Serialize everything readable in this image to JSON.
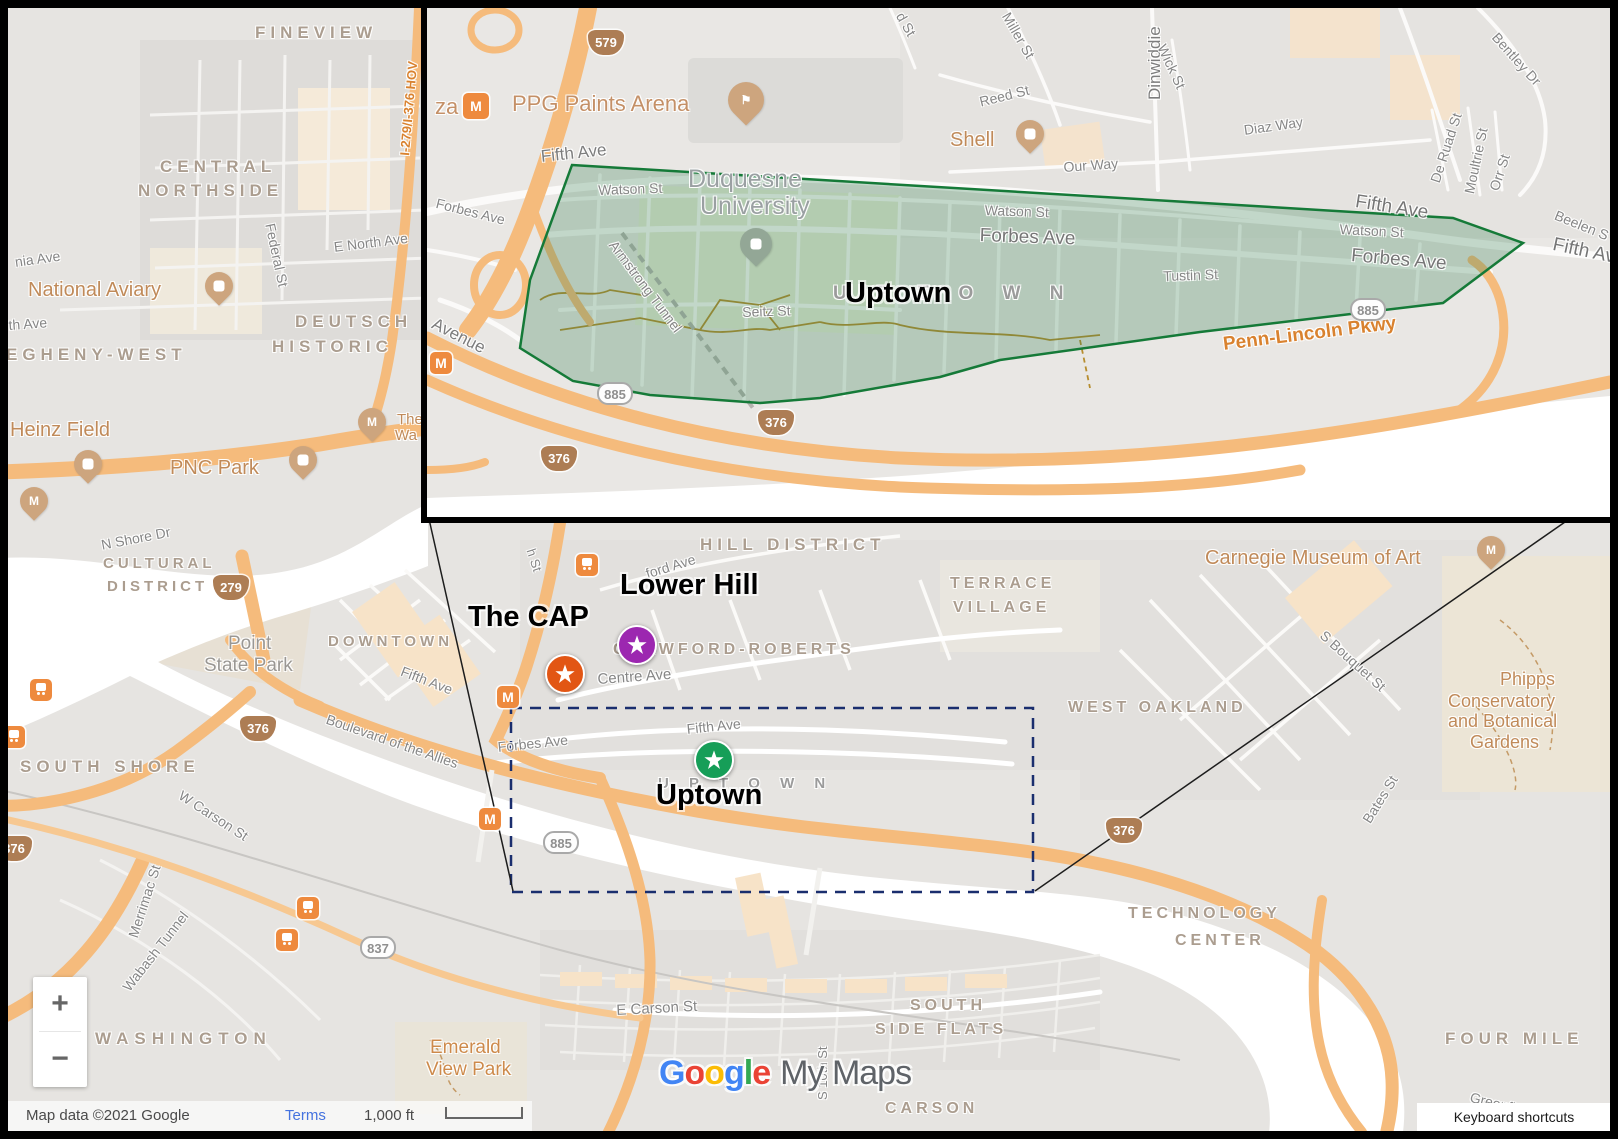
{
  "inset": {
    "labels": {
      "ppg_arena": "PPG Paints Arena",
      "za": "za",
      "m": "M",
      "fifth_ave": "Fifth Ave",
      "forbes_ave": "Forbes Ave",
      "watson_st": "Watson St",
      "duquesne_1": "Duquesne",
      "duquesne_2": "University",
      "uptown_bold": "Uptown",
      "uptown_area": "U P T O W N",
      "seitz_st": "Seitz St",
      "armstrong_tunnel": "Armstrong Tunnel",
      "tustin_st": "Tustin St",
      "penn_lincoln": "Penn-Lincoln Pkwy",
      "our_way": "Our Way",
      "diaz_way": "Diaz Way",
      "reed_st": "Reed St",
      "miller_st": "Miller St",
      "d_st": "d St",
      "dinwiddie": "Dinwiddie",
      "wick_st": "Wick St",
      "shell": "Shell",
      "bentley_dr": "Bentley Dr",
      "de_ruad_st": "De Ruad St",
      "moultrie_st": "Moultrie St",
      "orr_st": "Orr St",
      "beelen": "Beelen S",
      "avenue": "Avenue"
    }
  },
  "main": {
    "labels": {
      "fineview": "FINEVIEW",
      "central": "CENTRAL",
      "northside": "NORTHSIDE",
      "nia_ave": "nia Ave",
      "national_aviary": "National Aviary",
      "th_ave": "th Ave",
      "federal_st": "Federal St",
      "e_north_ave": "E North Ave",
      "deutsch": "DEUTSCH",
      "historic": "HISTORIC",
      "egheny_west": "EGHENY-WEST",
      "heinz_field": "Heinz Field",
      "pnc_park": "PNC Park",
      "the_1": "The",
      "the_2": "Wa",
      "n_shore_dr": "N Shore Dr",
      "cultural": "CULTURAL",
      "district": "DISTRICT",
      "downtown": "DOWNTOWN",
      "point_1": "Point",
      "point_2": "State Park",
      "fifth_ave": "Fifth Ave",
      "blvd_allies": "Boulevard of the Allies",
      "south_shore": "SOUTH SHORE",
      "w_carson_st": "W Carson St",
      "merrimac_st": "Merrimac St",
      "wabash_tunnel": "Wabash Tunnel",
      "washington": "WASHINGTON",
      "emerald_1": "Emerald",
      "emerald_2": "View Park",
      "hill_district": "HILL DISTRICT",
      "bedford_ave": "ford Ave",
      "h_st": "h St",
      "centre_ave": "Centre Ave",
      "forbes_ave": "Forbes Ave",
      "crawford_roberts": "CRAWFORD-ROBERTS",
      "terrace": "TERRACE",
      "village": "VILLAGE",
      "west_oakland": "WEST OAKLAND",
      "carnegie": "Carnegie Museum of Art",
      "s_bouquet_st": "S Bouquet St",
      "phipps_1": "Phipps",
      "phipps_2": "Conservatory",
      "phipps_3": "and Botanical",
      "phipps_4": "Gardens",
      "bates_st": "Bates St",
      "technology": "TECHNOLOGY",
      "center": "CENTER",
      "four_mile": "FOUR MILE",
      "greenfield_ave": "Greenfield Ave",
      "e_carson_st": "E Carson St",
      "south": "SOUTH",
      "side_flats": "SIDE FLATS",
      "carson": "CARSON",
      "s_10th_st": "S 10th St",
      "uptown_area": "U P T O W N",
      "hov": "I-279/I-376 HOV"
    }
  },
  "markers": [
    {
      "label": "The CAP",
      "color": "#E25614"
    },
    {
      "label": "Lower Hill",
      "color": "#9C27B0"
    },
    {
      "label": "Uptown",
      "color": "#169E58"
    }
  ],
  "shields": {
    "i579": "579",
    "i376": "376",
    "i279": "279",
    "r885": "885",
    "r837": "837"
  },
  "ui": {
    "zoom_in": "+",
    "zoom_out": "−",
    "attribution": "Map data ©2021 Google",
    "terms": "Terms",
    "scale_text": "1,000 ft",
    "keyboard_shortcuts": "Keyboard shortcuts"
  },
  "watermark": {
    "letters": [
      {
        "ch": "G",
        "color": "#4285F4"
      },
      {
        "ch": "o",
        "color": "#EA4335"
      },
      {
        "ch": "o",
        "color": "#FBBC05"
      },
      {
        "ch": "g",
        "color": "#4285F4"
      },
      {
        "ch": "l",
        "color": "#34A853"
      },
      {
        "ch": "e",
        "color": "#EA4335"
      }
    ],
    "suffix": "My Maps"
  },
  "colors": {
    "land": "#E6E4E1",
    "inset_land": "#E9E7E4",
    "water": "#FFFFFF",
    "highway": "#F5BB7C",
    "commercial": "#F7E3C8",
    "polygon_fill": "#2E7D4F",
    "polygon_stroke": "#157A38",
    "dashed_box": "#1A2E6E",
    "area_label": "#AB9D8F",
    "poi_label": "#C08A59",
    "marker_orange": "#E25614",
    "marker_purple": "#9C27B0",
    "marker_green": "#169E58"
  }
}
